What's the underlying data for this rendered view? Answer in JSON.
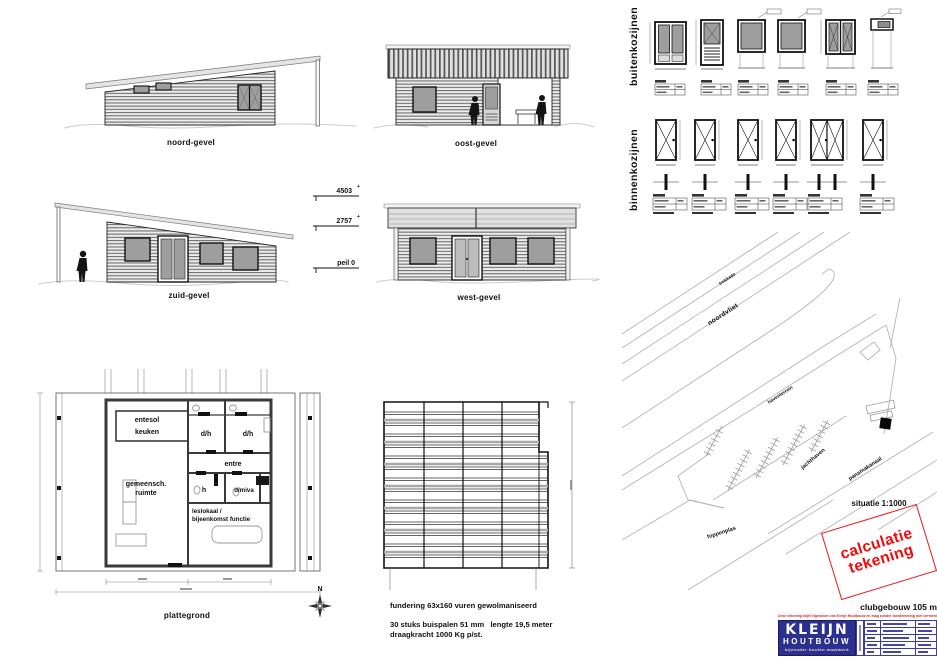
{
  "elevations": {
    "noord": {
      "label": "noord-gevel"
    },
    "oost": {
      "label": "oost-gevel"
    },
    "zuid": {
      "label": "zuid-gevel",
      "dim_top": "4503",
      "dim_mid": "2757",
      "dim_ground": "peil 0",
      "plus": "+"
    },
    "west": {
      "label": "west-gevel"
    }
  },
  "plattegrond": {
    "label": "plattegrond",
    "compass_north": "N",
    "rooms": {
      "entresol_line1": "entesol",
      "entresol_line2": "keuken",
      "dh_left": "d/h",
      "dh_right": "d/h",
      "gemeenschap_line1": "gemeensch.",
      "gemeenschap_line2": "ruimte",
      "entree": "entre",
      "hal": "h",
      "dmiva": "d/miva",
      "meterkast": "mk",
      "leslokaal_line1": "leslokaal /",
      "leslokaal_line2": "bijeenkomst functie"
    }
  },
  "fundering": {
    "note1": "fundering 63x160 vuren gewolmaniseerd",
    "note2": "30 stuks buispalen 51 mm   lengte 19,5 meter",
    "note3": "draagkracht 1000 Kg p/st."
  },
  "kozijnen": {
    "buiten_label": "buitenkozijnen",
    "binnen_label": "binnenkozijnen"
  },
  "situatie": {
    "label": "situatie 1:1000",
    "trekkade": "trekkade",
    "noordvliet": "noordvliet",
    "haventerrein": "haventerrein",
    "jachthaven": "jachthaven",
    "panamakanaal": "panamakanaal",
    "foppenplas": "foppenplas"
  },
  "stamp": {
    "line1": "calculatie",
    "line2": "tekening"
  },
  "titleblock": {
    "project_title": "clubgebouw 105 m",
    "copyright": "Deze tekening blijft eigendom van Kleijn Houtbouw  en mag zonder toestemming niet vermenigvuldigd worden",
    "logo_line1": "KLEIJN",
    "logo_line2": "HOUTBOUW",
    "logo_tagline": "bijzonder houten maatwerk"
  },
  "colors": {
    "stamp_red": "#f21616",
    "logo_blue": "#2b2f8e",
    "glass_gray": "#9e9e9e"
  }
}
